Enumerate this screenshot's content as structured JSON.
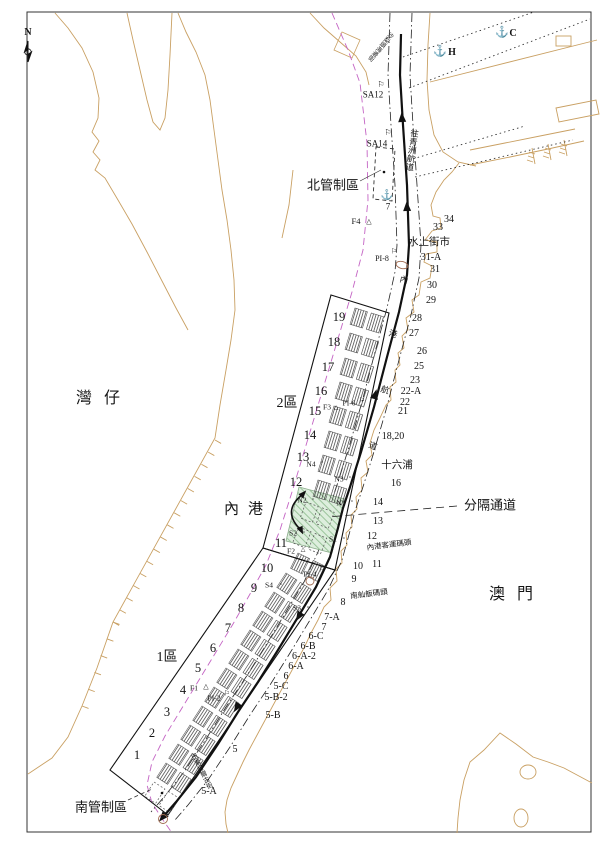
{
  "map_type": "harbour-navigation-chart",
  "colors": {
    "coastline": "#c9a063",
    "boundary_magenta": "#c464c4",
    "separation_fill": "#ddeedd",
    "separation_hatch": "#9bc49b",
    "route": "#111111",
    "marker_brown": "#a06a50"
  },
  "labels": [
    {
      "n": "compass-n-label",
      "t": "N",
      "x": 28,
      "y": 33,
      "s": 10,
      "b": 1
    },
    {
      "n": "wanzai-label",
      "t": "灣仔",
      "x": 104,
      "y": 399,
      "s": 16,
      "ls": 12
    },
    {
      "n": "neigang-label",
      "t": "內港",
      "x": 248,
      "y": 510,
      "s": 15,
      "ls": 9
    },
    {
      "n": "macau-label",
      "t": "澳門",
      "x": 517,
      "y": 595,
      "s": 16,
      "ls": 12
    },
    {
      "n": "north-control-label",
      "t": "北管制區",
      "x": 333,
      "y": 185,
      "s": 13
    },
    {
      "n": "south-control-label",
      "t": "南管制區",
      "x": 101,
      "y": 807,
      "s": 13
    },
    {
      "n": "separation-channel-label",
      "t": "分隔通道",
      "x": 490,
      "y": 505,
      "s": 13
    },
    {
      "n": "zone2-label",
      "t": "2區",
      "x": 287,
      "y": 404,
      "s": 14
    },
    {
      "n": "zone1-label",
      "t": "1區",
      "x": 167,
      "y": 658,
      "s": 14
    },
    {
      "n": "water-market-label",
      "t": "水上街市",
      "x": 429,
      "y": 243,
      "s": 10.5
    },
    {
      "n": "ponte16-label",
      "t": "十六浦",
      "x": 397,
      "y": 466,
      "s": 10.5
    },
    {
      "n": "ferry-terminal-label",
      "t": "內港客運碼頭",
      "x": 389,
      "y": 545,
      "s": 7.5,
      "r": -7
    },
    {
      "n": "sampan-pier-label",
      "t": "南舢舨碼頭",
      "x": 369,
      "y": 594,
      "s": 7.5,
      "r": -7
    },
    {
      "n": "to-ilha-verde-channel-label",
      "t": "往青洲航道",
      "x": 412,
      "y": 150,
      "s": 8.5,
      "v": 1,
      "r": 8
    },
    {
      "n": "fairway-char-1",
      "t": "內",
      "x": 404,
      "y": 280,
      "s": 8.5,
      "r": 15
    },
    {
      "n": "fairway-char-2",
      "t": "港",
      "x": 393,
      "y": 334,
      "s": 8.5,
      "r": 15
    },
    {
      "n": "fairway-char-3",
      "t": "航",
      "x": 385,
      "y": 390,
      "s": 8.5,
      "r": 18
    },
    {
      "n": "fairway-char-4",
      "t": "道",
      "x": 373,
      "y": 446,
      "s": 8.5,
      "r": 20
    },
    {
      "n": "north-street-label",
      "t": "沙梨頭海邊街",
      "x": 380,
      "y": 46,
      "s": 6,
      "v": 1,
      "r": 40
    },
    {
      "n": "south-street-label",
      "t": "巴素打爾古街",
      "x": 200,
      "y": 772,
      "s": 6.5,
      "v": 1,
      "r": -27
    },
    {
      "n": "mark-sa12-label",
      "t": "SA12",
      "x": 373,
      "y": 95,
      "s": 9
    },
    {
      "n": "mark-sa14-label",
      "t": "SA14",
      "x": 377,
      "y": 144,
      "s": 9
    },
    {
      "n": "mark-f4-label",
      "t": "F4",
      "x": 356,
      "y": 221,
      "s": 8.5
    },
    {
      "n": "mark-pi8-label",
      "t": "PI-8",
      "x": 382,
      "y": 259,
      "s": 8
    },
    {
      "n": "anchorage-h-label",
      "t": "H",
      "x": 452,
      "y": 53,
      "s": 10,
      "b": 1
    },
    {
      "n": "anchorage-c-label",
      "t": "C",
      "x": 513,
      "y": 34,
      "s": 10,
      "b": 1
    },
    {
      "n": "anchorage-7-label",
      "t": "7",
      "x": 388,
      "y": 207,
      "s": 9
    },
    {
      "n": "berth-19",
      "t": "19",
      "x": 339,
      "y": 317,
      "s": 12.5
    },
    {
      "n": "berth-18",
      "t": "18",
      "x": 334,
      "y": 342,
      "s": 12.5
    },
    {
      "n": "berth-17",
      "t": "17",
      "x": 328,
      "y": 367,
      "s": 12.5
    },
    {
      "n": "berth-16",
      "t": "16",
      "x": 321,
      "y": 391,
      "s": 12.5
    },
    {
      "n": "berth-15",
      "t": "15",
      "x": 315,
      "y": 411,
      "s": 12.5
    },
    {
      "n": "berth-14",
      "t": "14",
      "x": 310,
      "y": 435,
      "s": 12.5
    },
    {
      "n": "berth-13",
      "t": "13",
      "x": 303,
      "y": 457,
      "s": 12.5
    },
    {
      "n": "berth-12",
      "t": "12",
      "x": 296,
      "y": 482,
      "s": 12.5
    },
    {
      "n": "berth-11",
      "t": "11",
      "x": 281,
      "y": 543,
      "s": 12.5
    },
    {
      "n": "berth-10",
      "t": "10",
      "x": 267,
      "y": 568,
      "s": 12.5
    },
    {
      "n": "berth-9",
      "t": "9",
      "x": 254,
      "y": 588,
      "s": 12.5
    },
    {
      "n": "berth-8",
      "t": "8",
      "x": 241,
      "y": 608,
      "s": 12.5
    },
    {
      "n": "berth-7",
      "t": "7",
      "x": 228,
      "y": 628,
      "s": 12.5
    },
    {
      "n": "berth-6",
      "t": "6",
      "x": 213,
      "y": 648,
      "s": 12.5
    },
    {
      "n": "berth-5",
      "t": "5",
      "x": 198,
      "y": 668,
      "s": 12.5
    },
    {
      "n": "berth-4",
      "t": "4",
      "x": 183,
      "y": 690,
      "s": 12.5
    },
    {
      "n": "berth-3",
      "t": "3",
      "x": 167,
      "y": 712,
      "s": 12.5
    },
    {
      "n": "berth-2",
      "t": "2",
      "x": 152,
      "y": 733,
      "s": 12.5
    },
    {
      "n": "berth-1",
      "t": "1",
      "x": 137,
      "y": 755,
      "s": 12.5
    },
    {
      "n": "mark-f3-label",
      "t": "F3",
      "x": 327,
      "y": 407,
      "s": 7.5
    },
    {
      "n": "mark-pi6-label",
      "t": "PI-6",
      "x": 349,
      "y": 403,
      "s": 7.5
    },
    {
      "n": "mark-n4-label",
      "t": "N4",
      "x": 311,
      "y": 464,
      "s": 7.5
    },
    {
      "n": "mark-n3-label",
      "t": "N3",
      "x": 339,
      "y": 479,
      "s": 7.5
    },
    {
      "n": "mark-n2-label",
      "t": "N2",
      "x": 302,
      "y": 500,
      "s": 7.5
    },
    {
      "n": "mark-n1-label",
      "t": "N1",
      "x": 341,
      "y": 503,
      "s": 7.5
    },
    {
      "n": "mark-s2-label",
      "t": "S2",
      "x": 293,
      "y": 533,
      "s": 7.5
    },
    {
      "n": "mark-s1-label",
      "t": "S1",
      "x": 333,
      "y": 539,
      "s": 7.5
    },
    {
      "n": "mark-f2-label",
      "t": "F2",
      "x": 291,
      "y": 551,
      "s": 7.5
    },
    {
      "n": "mark-pi4-label",
      "t": "PI-4",
      "x": 310,
      "y": 574,
      "s": 7.5
    },
    {
      "n": "mark-s4-label",
      "t": "S4",
      "x": 269,
      "y": 585,
      "s": 7.5
    },
    {
      "n": "mark-s3-label",
      "t": "S3",
      "x": 297,
      "y": 608,
      "s": 7.5
    },
    {
      "n": "mark-f1-label",
      "t": "F1",
      "x": 194,
      "y": 688,
      "s": 7.5
    },
    {
      "n": "mark-pi2-label",
      "t": "PI-2",
      "x": 214,
      "y": 698,
      "s": 7.5
    },
    {
      "n": "pier-34",
      "t": "34",
      "x": 449,
      "y": 220,
      "s": 10
    },
    {
      "n": "pier-33",
      "t": "33",
      "x": 438,
      "y": 228,
      "s": 10
    },
    {
      "n": "pier-31a",
      "t": "31-A",
      "x": 431,
      "y": 258,
      "s": 10
    },
    {
      "n": "pier-31",
      "t": "31",
      "x": 435,
      "y": 270,
      "s": 10
    },
    {
      "n": "pier-30",
      "t": "30",
      "x": 432,
      "y": 286,
      "s": 10
    },
    {
      "n": "pier-29",
      "t": "29",
      "x": 431,
      "y": 301,
      "s": 10
    },
    {
      "n": "pier-28",
      "t": "28",
      "x": 417,
      "y": 319,
      "s": 10
    },
    {
      "n": "pier-27",
      "t": "27",
      "x": 414,
      "y": 334,
      "s": 10
    },
    {
      "n": "pier-26",
      "t": "26",
      "x": 422,
      "y": 352,
      "s": 10
    },
    {
      "n": "pier-25",
      "t": "25",
      "x": 419,
      "y": 367,
      "s": 10
    },
    {
      "n": "pier-23",
      "t": "23",
      "x": 415,
      "y": 381,
      "s": 10
    },
    {
      "n": "pier-22a",
      "t": "22-A",
      "x": 411,
      "y": 392,
      "s": 10
    },
    {
      "n": "pier-22",
      "t": "22",
      "x": 405,
      "y": 403,
      "s": 10
    },
    {
      "n": "pier-21",
      "t": "21",
      "x": 403,
      "y": 412,
      "s": 10
    },
    {
      "n": "pier-18-20",
      "t": "18,20",
      "x": 393,
      "y": 437,
      "s": 10
    },
    {
      "n": "pier-16",
      "t": "16",
      "x": 396,
      "y": 484,
      "s": 10
    },
    {
      "n": "pier-14",
      "t": "14",
      "x": 378,
      "y": 503,
      "s": 10
    },
    {
      "n": "pier-13",
      "t": "13",
      "x": 378,
      "y": 522,
      "s": 10
    },
    {
      "n": "pier-12",
      "t": "12",
      "x": 372,
      "y": 537,
      "s": 10
    },
    {
      "n": "pier-11",
      "t": "11",
      "x": 377,
      "y": 565,
      "s": 10
    },
    {
      "n": "pier-10",
      "t": "10",
      "x": 358,
      "y": 567,
      "s": 10
    },
    {
      "n": "pier-9",
      "t": "9",
      "x": 354,
      "y": 580,
      "s": 10
    },
    {
      "n": "pier-8",
      "t": "8",
      "x": 343,
      "y": 603,
      "s": 10
    },
    {
      "n": "pier-7a",
      "t": "7-A",
      "x": 332,
      "y": 618,
      "s": 10
    },
    {
      "n": "pier-7",
      "t": "7",
      "x": 324,
      "y": 628,
      "s": 10
    },
    {
      "n": "pier-6c",
      "t": "6-C",
      "x": 316,
      "y": 637,
      "s": 10
    },
    {
      "n": "pier-6b",
      "t": "6-B",
      "x": 308,
      "y": 647,
      "s": 10
    },
    {
      "n": "pier-6a2",
      "t": "6-A-2",
      "x": 304,
      "y": 657,
      "s": 10
    },
    {
      "n": "pier-6a",
      "t": "6-A",
      "x": 296,
      "y": 667,
      "s": 10
    },
    {
      "n": "pier-6",
      "t": "6",
      "x": 286,
      "y": 677,
      "s": 10
    },
    {
      "n": "pier-5c",
      "t": "5-C",
      "x": 281,
      "y": 687,
      "s": 10
    },
    {
      "n": "pier-5b2",
      "t": "5-B-2",
      "x": 276,
      "y": 698,
      "s": 10
    },
    {
      "n": "pier-5b",
      "t": "5-B",
      "x": 273,
      "y": 716,
      "s": 10
    },
    {
      "n": "pier-5",
      "t": "5",
      "x": 235,
      "y": 750,
      "s": 10
    },
    {
      "n": "pier-5a",
      "t": "5-A",
      "x": 209,
      "y": 792,
      "s": 10
    }
  ],
  "symbols": [
    {
      "n": "anchor-icon",
      "g": "⚓",
      "x": 440,
      "y": 52,
      "s": 11
    },
    {
      "n": "anchor-icon",
      "g": "⚓",
      "x": 502,
      "y": 33,
      "s": 11
    },
    {
      "n": "anchor-icon",
      "g": "⚓",
      "x": 387,
      "y": 196,
      "s": 10
    },
    {
      "n": "flag-icon",
      "g": "⚐",
      "x": 381,
      "y": 85,
      "s": 8
    },
    {
      "n": "flag-icon",
      "g": "⚐",
      "x": 388,
      "y": 133,
      "s": 8
    },
    {
      "n": "flag-icon",
      "g": "⚐",
      "x": 394,
      "y": 252,
      "s": 7
    },
    {
      "n": "flag-icon",
      "g": "⚐",
      "x": 362,
      "y": 401,
      "s": 7
    },
    {
      "n": "flag-icon",
      "g": "⚐",
      "x": 322,
      "y": 570,
      "s": 7
    },
    {
      "n": "flag-icon",
      "g": "⚐",
      "x": 227,
      "y": 694,
      "s": 7
    },
    {
      "n": "triangle-beacon-icon",
      "g": "△",
      "x": 369,
      "y": 222,
      "s": 7
    },
    {
      "n": "triangle-beacon-icon",
      "g": "△",
      "x": 336,
      "y": 408,
      "s": 6
    },
    {
      "n": "triangle-beacon-icon",
      "g": "△",
      "x": 303,
      "y": 550,
      "s": 6
    },
    {
      "n": "triangle-beacon-icon",
      "g": "△",
      "x": 206,
      "y": 687,
      "s": 7
    },
    {
      "n": "square-mark-icon",
      "g": "▫",
      "x": 322,
      "y": 463,
      "s": 6
    },
    {
      "n": "square-mark-icon",
      "g": "▫",
      "x": 350,
      "y": 478,
      "s": 6
    },
    {
      "n": "square-mark-icon",
      "g": "▫",
      "x": 313,
      "y": 500,
      "s": 6
    },
    {
      "n": "square-mark-icon",
      "g": "▫",
      "x": 352,
      "y": 502,
      "s": 6
    },
    {
      "n": "square-mark-icon",
      "g": "▫",
      "x": 304,
      "y": 533,
      "s": 6
    },
    {
      "n": "square-mark-icon",
      "g": "▫",
      "x": 344,
      "y": 539,
      "s": 6
    },
    {
      "n": "square-mark-icon",
      "g": "▫",
      "x": 281,
      "y": 585,
      "s": 6
    },
    {
      "n": "square-mark-icon",
      "g": "▫",
      "x": 308,
      "y": 608,
      "s": 6
    }
  ]
}
